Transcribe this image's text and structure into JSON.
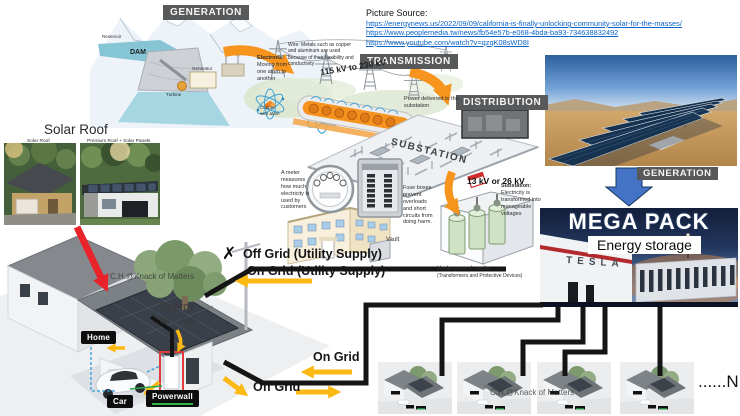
{
  "source": {
    "title": "Picture Source:",
    "links": [
      "https://energynews.us/2022/09/09/california-is-finally-unlocking-community-solar-for-the-masses/",
      "https://www.peoplemedia.tw/news/fb54e57b-e068-4bda-ba93-734638832492",
      "https://www.youtube.com/watch?v=qzqK08sWD8I"
    ]
  },
  "stages": {
    "generation": "GENERATION",
    "transmission": "TRANSMISSION",
    "distribution": "DISTRIBUTION",
    "generation_right": "GENERATION"
  },
  "dam": {
    "name": "DAM",
    "reservoir": "Reservoir",
    "generator": "Generator",
    "turbine": "Turbine"
  },
  "transmission": {
    "electrons_title": "Electrons:",
    "electrons_body": "Moving from one atom to another",
    "wire_note": "Wire: Metals such as copper and aluminum are used because of their flexibility and conductivity",
    "voltage": "115 kV to 230 kV",
    "copper_atom": "Copper wire atom",
    "delivered": "Power delivered to the substation"
  },
  "substation": {
    "name": "SUBSTATION",
    "note_title": "Substation:",
    "note_body": "Electricity is transformed into manageable voltages"
  },
  "customer": {
    "meter_note": "A meter measures how much electricity is used by customers",
    "fuse_note": "Fuse boxes prevent overloads and short circuits from doing harm.",
    "vault": "Vault"
  },
  "underground": {
    "voltage": "13 kV or 26 kV",
    "caption": "Underground vaults",
    "caption_sub": "(Transformers and Protective Devices)"
  },
  "solar_roof": {
    "heading": "Solar Roof",
    "left_caption": "Solar Roof",
    "right_caption": "Premium Roof + Solar Panels"
  },
  "megapack": {
    "title": "MEGA PACK",
    "subtitle": "Energy storage",
    "brand": "TESLA"
  },
  "home": {
    "watermark": "C.H.@Knack of Matters",
    "energy_storage": "Energy storage",
    "home_chip": "Home",
    "car_chip": "Car",
    "powerwall_chip": "Powerwall"
  },
  "grid": {
    "x": "✗",
    "off_utility": "Off Grid (Utility Supply)",
    "on_utility": "On Grid (Utility Supply)",
    "on": "On Grid",
    "off": "Off Grid"
  },
  "row": {
    "watermark": "C.H.@Knack of Matters",
    "n": "......N"
  },
  "colors": {
    "accent_orange": "#f7941d",
    "accent_yellow": "#fdb913",
    "cable_black": "#151515",
    "link_blue": "#0b63c8",
    "label_gray": "#58595b",
    "arrow_blue": "#4472c4",
    "arrow_red": "#e8242a"
  }
}
